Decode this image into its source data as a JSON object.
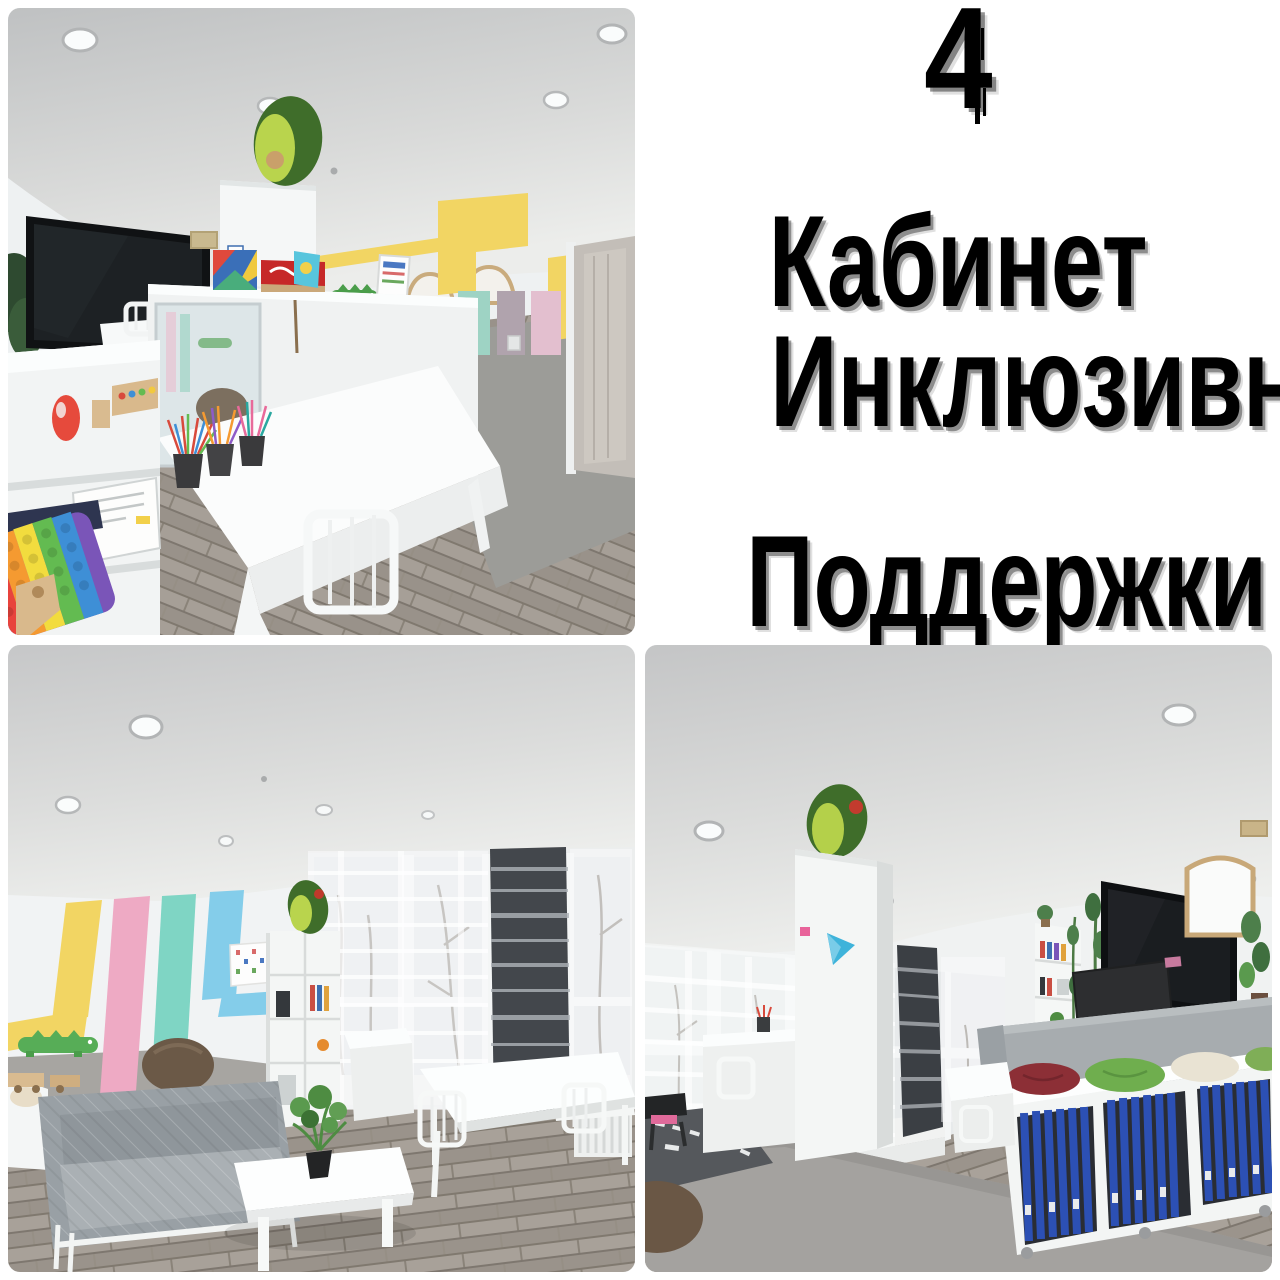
{
  "slide": {
    "number": "4",
    "title_lines": [
      "Кабинет",
      "Инклюзивной",
      "Поддержки"
    ]
  },
  "photos": [
    {
      "id": "top-left",
      "description": "Classroom with black interactive TV panel, white desks and chairs, mirror divider, pencil cups, rainbow pop-it toy, avocado plush on a white cabinet, Kazakh flag, yellow geometric wall stripe and gray door"
    },
    {
      "id": "bottom-left",
      "description": "Classroom corner with yellow, pink, teal and blue wall stripes, green crocodile decor, gray quilted sofa, white coffee table with a plant, white desks and windows with sheer and dark curtains"
    },
    {
      "id": "bottom-right",
      "description": "Large classroom with a window wall and sheer curtains, tall white cabinet with avocado plush, white desks, TV panel, wooden mirror, gray sofa and a white shelf full of blue binders with cushions on top"
    }
  ],
  "palette": {
    "background": "#ffffff",
    "title_text": "#000000",
    "stripe_yellow": "#f2d563",
    "stripe_pink": "#eeaac4",
    "stripe_teal": "#7fd5c4",
    "stripe_blue": "#84cdea",
    "floor_wood": "#99928a",
    "carpet": "#9c9c98",
    "sofa_gray": "#99a0a5",
    "avocado_dark": "#3f6d2a",
    "avocado_light": "#b9d44d",
    "binder_blue": "#2a4db0",
    "kazakh_flag_blue": "#57c5dd",
    "tv_black": "#101214"
  }
}
